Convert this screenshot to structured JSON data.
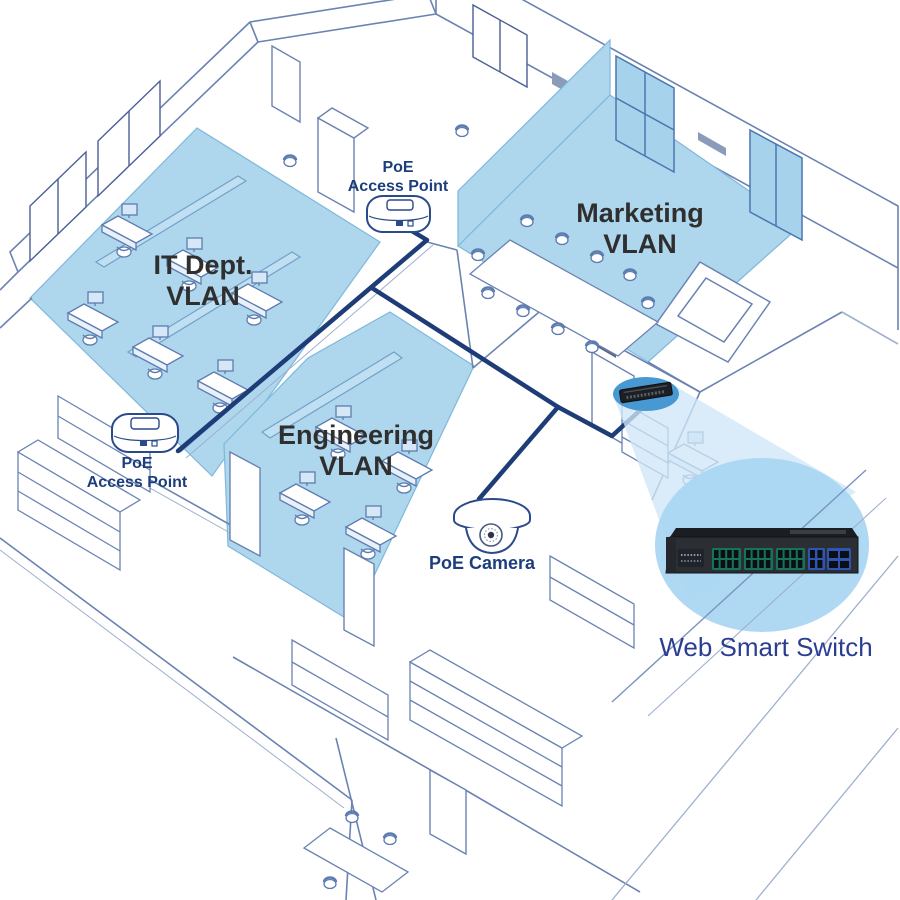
{
  "diagram_title": "PoE VLAN office network diagram",
  "vlans": {
    "it": {
      "line1": "IT Dept.",
      "line2": "VLAN"
    },
    "engineering": {
      "line1": "Engineering",
      "line2": "VLAN"
    },
    "marketing": {
      "line1": "Marketing",
      "line2": "VLAN"
    }
  },
  "devices": {
    "access_point_top": {
      "line1": "PoE",
      "line2": "Access Point"
    },
    "access_point_left": {
      "line1": "PoE",
      "line2": "Access Point"
    },
    "poe_camera": {
      "label": "PoE Camera"
    },
    "web_smart_switch": {
      "label": "Web Smart Switch",
      "green_ports": 24,
      "blue_ports": 4,
      "sfp_slots": 4
    }
  },
  "icons": {
    "access_point": "wireless-access-point-icon",
    "dome_camera": "dome-camera-icon",
    "rack_switch": "rack-switch-icon"
  },
  "colors": {
    "vlan_fill": "#aed6ec",
    "vlan_edge": "#7fb8dd",
    "panel_fill": "#bfdff2",
    "window_blue": "#a7d2ec",
    "line_art": "#6b83b3",
    "line_art_light": "#9db0cf",
    "line_art_dark": "#4a5f96",
    "trunk": "#1e3c78",
    "label_navy": "#1d3e7d",
    "label_dark": "#2f2f2f",
    "switch_label": "#2b3e91",
    "callout_small": "#4899d2",
    "callout_beam": "#cfe7f7",
    "callout_big": "#abd7f2",
    "switch_body": "#2b2e33",
    "switch_top": "#1a1d21",
    "port_green": "#17725c",
    "port_blue": "#2f55b0",
    "port_dark": "#0b0e12"
  }
}
